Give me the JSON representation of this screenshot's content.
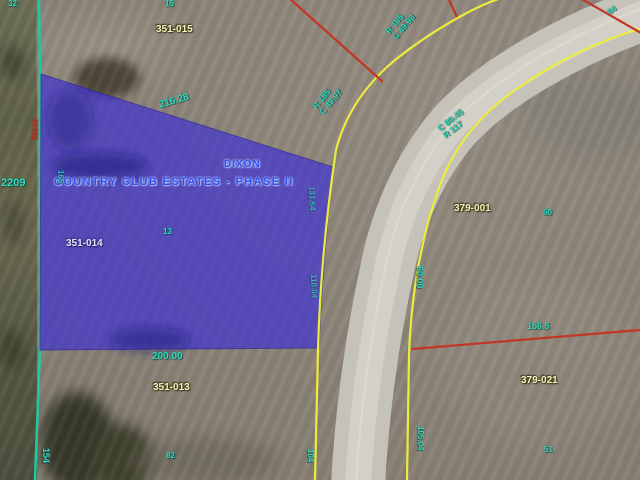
{
  "map": {
    "parcels": {
      "n351_015": "351-015",
      "n351_014": "351-014",
      "n351_013": "351-013",
      "n379_001": "379-001",
      "n379_021": "379-021"
    },
    "subdivision": {
      "line1": "DIXON",
      "line2": "COUNTRY CLUB ESTATES - PHASE II"
    },
    "dimensions": {
      "top_edge": "216.28",
      "bottom_edge": "200.00",
      "west_frontage": "2209",
      "southeast": "156.5",
      "curve_c": "C 80.45",
      "curve_r": "R 117",
      "curve2_r": "R 185",
      "curve2_c": "C 49.98",
      "curve3_r": "R 185",
      "curve3_c": "C 49.97",
      "road_east": "60.00",
      "road_east_lower": "105.04",
      "road_west_lower": "104",
      "west_lower": "154",
      "lot_82": "82",
      "lot_50": "50",
      "lot_51": "51",
      "lot_13": "13",
      "west_side": "165",
      "east_side_upper": "131.54",
      "east_side_lower": "110.04",
      "west_red": "40421",
      "frag_top_left": "32",
      "frag_top_center": "15",
      "frag_top_right": "64"
    },
    "colors": {
      "parcel_highlight": "#4a3fd0",
      "parcel_line_yellow": "#eeee44",
      "survey_line_teal": "#22c8a2",
      "lot_line_red": "#c43524",
      "dim_text_teal": "#35dac0",
      "parcel_label_yellow": "#f4f2bc",
      "subdivision_text_blue": "#2d4ef0"
    }
  }
}
